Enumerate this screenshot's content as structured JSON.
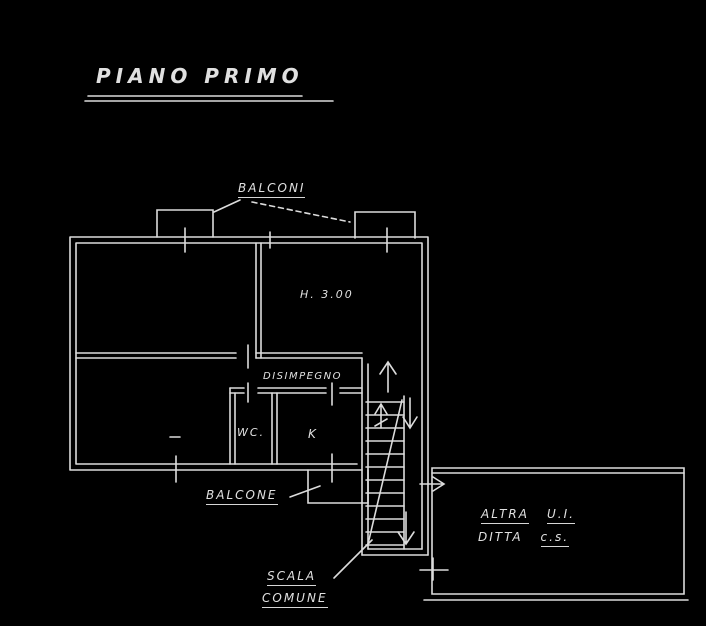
{
  "title": "PIANO PRIMO",
  "colors": {
    "background": "#000000",
    "line": "#dcdcdc"
  },
  "labels": {
    "balconies": "BALCONI",
    "room_height": "H. 3.00",
    "hallway": "DISIMPEGNO",
    "wc": "WC.",
    "kitchen": "K",
    "balcony": "BALCONE",
    "stair_line1": "SCALA",
    "stair_line2": "COMUNE",
    "other_unit_line1a": "ALTRA",
    "other_unit_line1b": "U.I.",
    "other_unit_line2a": "DITTA",
    "other_unit_line2b": "c.s."
  }
}
